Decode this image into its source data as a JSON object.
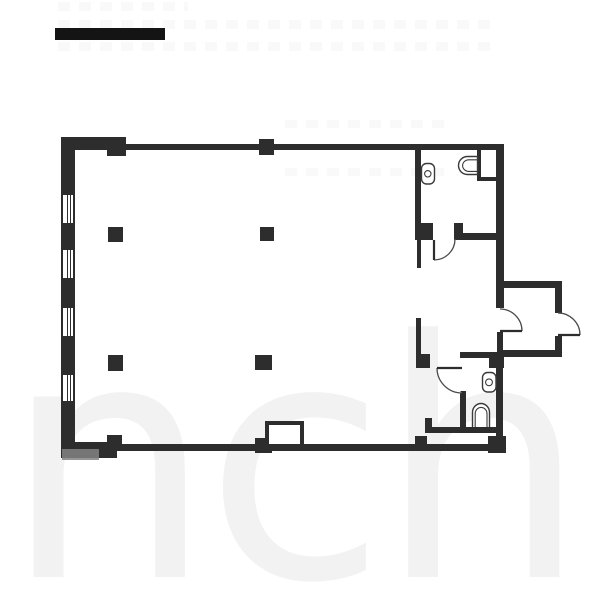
{
  "meta": {
    "type": "floor-plan",
    "background_color": "#ffffff",
    "wall_color": "#2d2d2d",
    "line_color": "#3a3a3a"
  },
  "watermark": {
    "text": "inch",
    "color": "#f2f2f2"
  },
  "top_bar": {
    "x": 55,
    "y": 28,
    "w": 110,
    "h": 12,
    "color": "#141414"
  },
  "rooms": [
    {
      "name": "main-room"
    },
    {
      "name": "bathroom-top-right"
    },
    {
      "name": "bathroom-bottom-right"
    },
    {
      "name": "entry-corridor"
    },
    {
      "name": "entrance-vestibule"
    },
    {
      "name": "duct-closet"
    }
  ],
  "walls": [
    {
      "name": "top-wall-left-thick",
      "x": 61,
      "y": 137,
      "w": 60,
      "h": 13
    },
    {
      "name": "top-wall-pier",
      "x": 107,
      "y": 137,
      "w": 19,
      "h": 19
    },
    {
      "name": "top-wall",
      "x": 121,
      "y": 144,
      "w": 383,
      "h": 6
    },
    {
      "name": "top-wall-column",
      "x": 259,
      "y": 139,
      "w": 15,
      "h": 16
    },
    {
      "name": "left-wall-1",
      "x": 61,
      "y": 137,
      "w": 14,
      "h": 58
    },
    {
      "name": "left-wall-2",
      "x": 61,
      "y": 223,
      "w": 14,
      "h": 27
    },
    {
      "name": "left-wall-3",
      "x": 61,
      "y": 278,
      "w": 14,
      "h": 30
    },
    {
      "name": "left-wall-4",
      "x": 61,
      "y": 336,
      "w": 14,
      "h": 39
    },
    {
      "name": "left-wall-5",
      "x": 61,
      "y": 401,
      "w": 14,
      "h": 56
    },
    {
      "name": "bottom-wall",
      "x": 61,
      "y": 444,
      "w": 445,
      "h": 7
    },
    {
      "name": "bottom-wall-corner",
      "x": 61,
      "y": 442,
      "w": 56,
      "h": 16
    },
    {
      "name": "bottom-wall-column-1",
      "x": 107,
      "y": 435,
      "w": 15,
      "h": 16
    },
    {
      "name": "bottom-wall-column-2",
      "x": 255,
      "y": 438,
      "w": 17,
      "h": 15
    },
    {
      "name": "right-wall-upper",
      "x": 496,
      "y": 144,
      "w": 8,
      "h": 164
    },
    {
      "name": "right-wall-mid",
      "x": 497,
      "y": 332,
      "w": 6,
      "h": 20
    },
    {
      "name": "right-wall-lower",
      "x": 496,
      "y": 368,
      "w": 7,
      "h": 76
    },
    {
      "name": "bottom-right-block",
      "x": 488,
      "y": 436,
      "w": 18,
      "h": 17
    },
    {
      "name": "bath1-left-wall",
      "x": 415,
      "y": 150,
      "w": 6,
      "h": 73
    },
    {
      "name": "bath1-door-block",
      "x": 415,
      "y": 223,
      "w": 18,
      "h": 17
    },
    {
      "name": "bath1-door-jamb",
      "x": 454,
      "y": 223,
      "w": 9,
      "h": 17
    },
    {
      "name": "bath1-bottom-wall",
      "x": 458,
      "y": 233,
      "w": 39,
      "h": 7
    },
    {
      "name": "closet-wall-left",
      "x": 477,
      "y": 150,
      "w": 4,
      "h": 31
    },
    {
      "name": "closet-wall-bottom",
      "x": 477,
      "y": 177,
      "w": 21,
      "h": 4
    },
    {
      "name": "corridor-wall-upper",
      "x": 417,
      "y": 240,
      "w": 4,
      "h": 28
    },
    {
      "name": "corridor-wall-lower",
      "x": 416,
      "y": 318,
      "w": 5,
      "h": 37
    },
    {
      "name": "corridor-wall-foot",
      "x": 416,
      "y": 354,
      "w": 14,
      "h": 14
    },
    {
      "name": "bath2-top-wall",
      "x": 460,
      "y": 352,
      "w": 30,
      "h": 6
    },
    {
      "name": "bath2-junction-block",
      "x": 489,
      "y": 352,
      "w": 15,
      "h": 16
    },
    {
      "name": "bath2-left-wall",
      "x": 460,
      "y": 391,
      "w": 6,
      "h": 41
    },
    {
      "name": "bath2-bottom-wall",
      "x": 425,
      "y": 427,
      "w": 71,
      "h": 6
    },
    {
      "name": "bath2-left-stub",
      "x": 425,
      "y": 418,
      "w": 7,
      "h": 12
    },
    {
      "name": "bottom-step-block",
      "x": 415,
      "y": 436,
      "w": 12,
      "h": 9
    },
    {
      "name": "porch-top-wall",
      "x": 503,
      "y": 281,
      "w": 59,
      "h": 7
    },
    {
      "name": "porch-right-wall-up",
      "x": 555,
      "y": 281,
      "w": 7,
      "h": 32
    },
    {
      "name": "porch-right-wall-low",
      "x": 555,
      "y": 336,
      "w": 7,
      "h": 21
    },
    {
      "name": "porch-bottom-wall",
      "x": 503,
      "y": 350,
      "w": 59,
      "h": 7
    },
    {
      "name": "column-a1",
      "x": 108,
      "y": 227,
      "w": 15,
      "h": 15
    },
    {
      "name": "column-a2",
      "x": 260,
      "y": 227,
      "w": 14,
      "h": 14
    },
    {
      "name": "column-b1",
      "x": 108,
      "y": 355,
      "w": 15,
      "h": 16
    },
    {
      "name": "column-b2",
      "x": 255,
      "y": 355,
      "w": 17,
      "h": 15
    }
  ],
  "windows": [
    {
      "x": 61,
      "y": 195,
      "w": 14,
      "h": 28
    },
    {
      "x": 61,
      "y": 250,
      "w": 14,
      "h": 28
    },
    {
      "x": 61,
      "y": 308,
      "w": 14,
      "h": 28
    },
    {
      "x": 61,
      "y": 375,
      "w": 14,
      "h": 26
    }
  ],
  "niche": {
    "name": "bottom-wall-niche",
    "x": 265,
    "y": 421,
    "w": 39,
    "h": 27
  },
  "doors": [
    {
      "name": "bath1-door",
      "leaf": "M434,240 L434,260",
      "arc": "M434,260 A21,21 0 0 0 455,239"
    },
    {
      "name": "bath2-door",
      "leaf": "M437,368 L462,368",
      "arc": "M437,368 A25,25 0 0 0 462,393"
    },
    {
      "name": "entry-inner-door",
      "leaf": "M500,331 L522,331",
      "arc": "M522,331 A22,22 0 0 0 500,309"
    },
    {
      "name": "entry-outer-door",
      "leaf": "M558,335 L580,335",
      "arc": "M580,335 A22,22 0 0 0 558,313"
    }
  ],
  "fixtures": [
    {
      "name": "toilet-bath1",
      "rect": [
        421.5,
        163.5,
        13,
        20.5,
        5
      ],
      "circle": [
        427.8,
        173.8,
        3.2
      ]
    },
    {
      "name": "sink-bath1",
      "paths": [
        "M477.5,156.5 L467.5,156.5 A9,9 0 0 0 467.5,174.5 L477.5,174.5 Z",
        "M477.5,159.8 L468.8,159.8 A6.2,5.8 0 0 0 468.8,171.4 L477.5,171.4"
      ]
    },
    {
      "name": "toilet-bath2",
      "rect": [
        482.5,
        372.5,
        13.5,
        19.5,
        5
      ],
      "circle": [
        489,
        382.3,
        3.4
      ]
    },
    {
      "name": "sink-bath2",
      "paths": [
        "M472.5,427 L472.5,412.5 A8.5,9 0 0 1 489.5,412.5 L489.5,427",
        "M475.2,427 L475.2,413.8 A5.9,6.4 0 0 1 487,413.8 L487,427"
      ]
    }
  ],
  "wm_strips": [
    {
      "x": 58,
      "y": 2,
      "w": 130,
      "h": 9
    },
    {
      "x": 58,
      "y": 20,
      "w": 440,
      "h": 9
    },
    {
      "x": 58,
      "y": 42,
      "w": 440,
      "h": 9
    },
    {
      "x": 285,
      "y": 120,
      "w": 160,
      "h": 8
    },
    {
      "x": 285,
      "y": 168,
      "w": 160,
      "h": 8
    }
  ],
  "gray_patch": {
    "x": 62,
    "y": 449,
    "w": 37,
    "h": 11
  }
}
